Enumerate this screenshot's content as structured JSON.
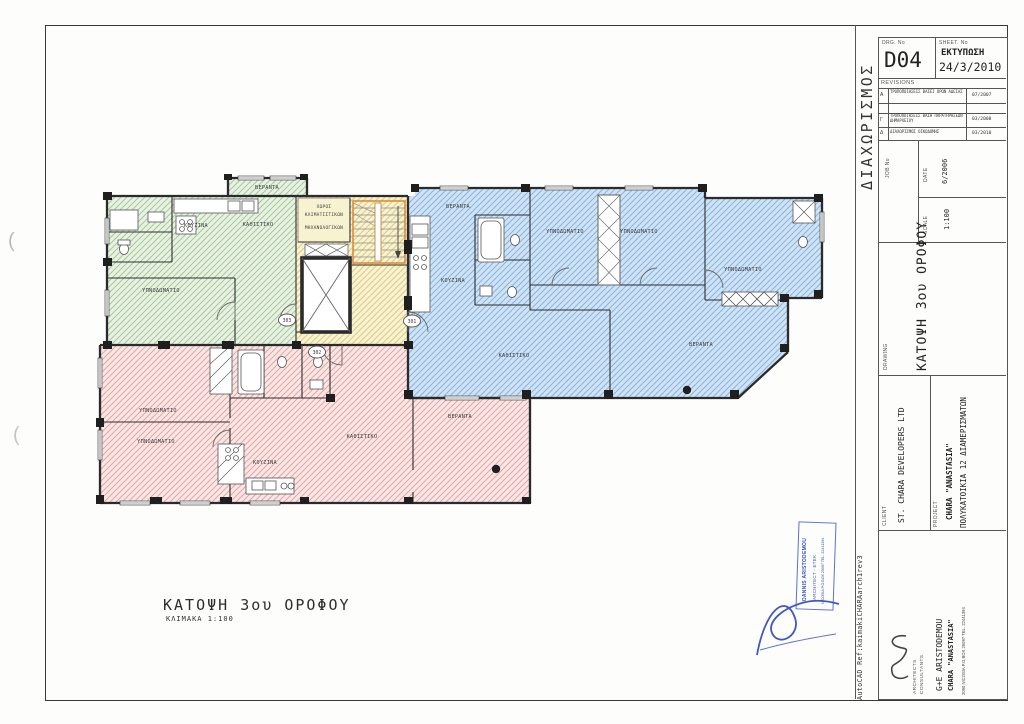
{
  "tb": {
    "margin_label": "ΔΙΑΧΩΡΙΣΜΟΣ",
    "autocad_ref": "AutoCAD  Ref:kaimakiCHARAarch1rev3",
    "drg_label": "DRG. No",
    "drg_no": "D04",
    "sheet_label": "SHEET. No",
    "print_label": "ΕΚΤΥΠΩΣΗ",
    "print_date": "24/3/2010",
    "revisions_title": "REVISIONS",
    "revisions": [
      {
        "id": "A",
        "desc": "ΤΡΟΠΟΠΟΙΗΣΕΙΣ ΒΑΣΕΙ ΟΡΩΝ ΑΔΕΙΑΣ",
        "date": "07/2007"
      },
      {
        "id": "Γ",
        "desc": "ΤΡΟΠΟΠΟΙΗΣΕΙΣ ΒΑΣΗ ΠΑΡΑΤΗΡΗΣΕΩΝ ΔΗΜΑΡΧΕΙΟΥ",
        "date": "03/2008"
      },
      {
        "id": "Δ",
        "desc": "ΔΙΑΧΩΡΙΣΜΟΣ ΟΙΚΟΔΟΜΗΣ",
        "date": "03/2010"
      }
    ],
    "job_label": "JOB  No",
    "date_label": "DATE",
    "date_value": "6/2006",
    "scale_label": "SCALE",
    "scale_value": "1:100",
    "drawing_label": "DRAWING",
    "drawing_value": "ΚΑΤΟΨΗ  3ου  ΟΡΟΦΟΥ",
    "client_label": "CLIENT",
    "client_value": "ST. CHARA DEVELOPERS LTD",
    "project_label": "PROJECT",
    "project_name": "CHARA \"ANASTASIA\"",
    "project_desc": "ΠΟΛΥΚΑΤΟΙΚΙΑ 12 ΔΙΑΜΕΡΙΣΜΑΤΩΝ",
    "firm_role1": "ARCHITECTS",
    "firm_role2": "CONSULTANTS",
    "firm_name": "G+E  ARISTODEMOU",
    "firm_project": "CHARA \"ANASTASIA\"",
    "firm_address": "2090 NICOSIA P.O.BOX 25097 TEL. 22441394"
  },
  "stamp": {
    "line1": "IOANNIS ARISTODEMOU",
    "line2": "ARCHITECT - ΕΤΕΚ",
    "line3": "NICOSIA P.O.BOX 25097 TEL. 22441394"
  },
  "caption": {
    "title": "ΚΑΤΟΨΗ 3ου ΟΡΟΦΟΥ",
    "scale": "ΚΛΙΜΑΚΑ 1:100"
  },
  "plan": {
    "units": [
      "301",
      "302",
      "303"
    ],
    "rooms": [
      "ΒΕΡΑΝΤΑ",
      "ΚΟΥΖΙΝΑ",
      "ΚΑΘΙΣΤΙΚΟ",
      "ΥΠΝΟΔΩΜΑΤΙΟ",
      "ΧΩΡΟΣ",
      "ΚΛΙΜΑΤΙΣΤΙΚΩΝ",
      "ΜΗΧΑΝΟΛΟΓΙΚΩΝ",
      "ΒΕΡΑΝΤΑ",
      "ΚΟΥΖΙΝΑ",
      "ΥΠΝΟΔΩΜΑΤΙΟ",
      "ΥΠΝΟΔΩΜΑΤΙΟ",
      "ΥΠΝΟΔΩΜΑΤΙΟ",
      "ΚΑΘΙΣΤΙΚΟ",
      "ΒΕΡΑΝΤΑ",
      "ΥΠΝΟΔΩΜΑΤΙΟ",
      "ΥΠΝΟΔΩΜΑΤΙΟ",
      "ΚΟΥΖΙΝΑ",
      "ΚΑΘΙΣΤΙΚΟ",
      "ΒΕΡΑΝΤΑ"
    ],
    "colors": {
      "unit_301": "#8ab4de",
      "unit_302": "#e6a8a8",
      "unit_303": "#a6c89c",
      "core": "#e2d27e",
      "stairs": "#e0862d",
      "stamp": "#3550c0"
    }
  }
}
